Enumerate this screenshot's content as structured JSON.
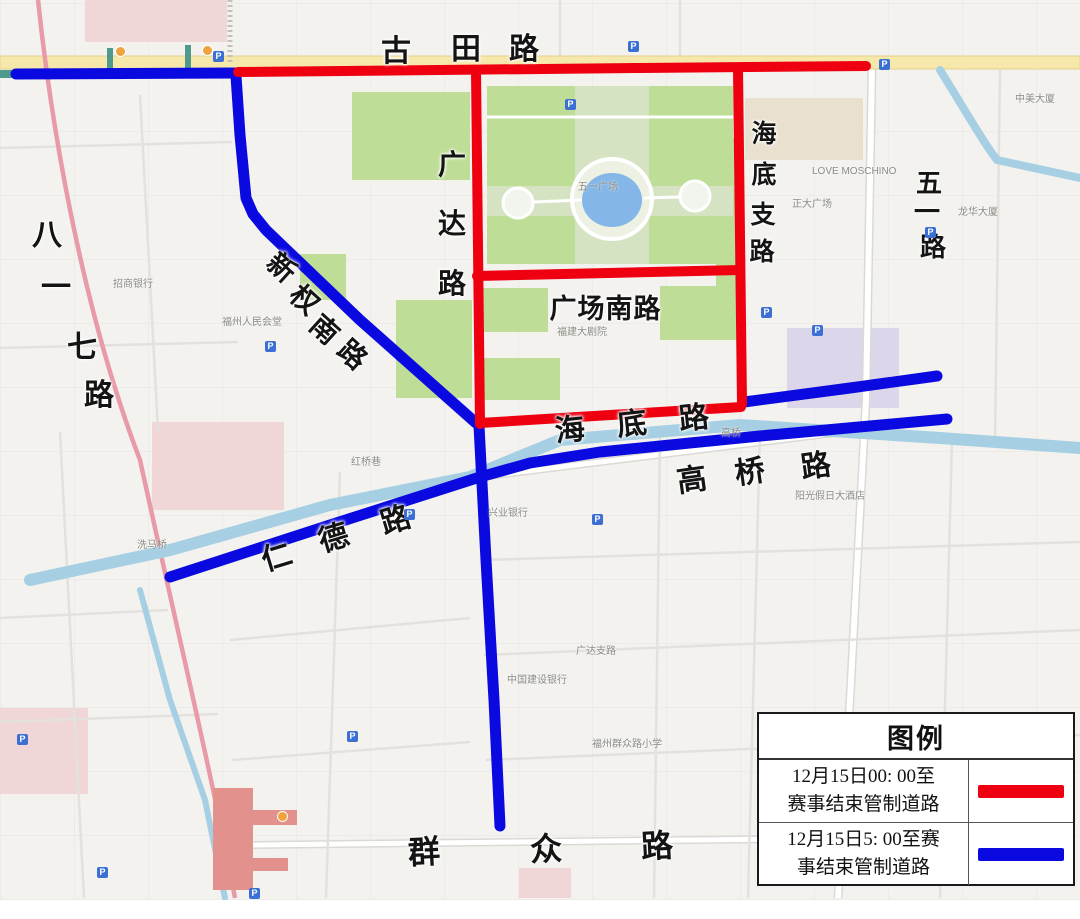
{
  "colors": {
    "restricted_red": "#ee0011",
    "restricted_blue": "#0a0ae0",
    "park_green": "#bedd96",
    "plaza_green": "#d6e3c3",
    "water_blue": "#a6cfe3",
    "pond_blue": "#84b7e8",
    "road_yellow": "#f6e8ab",
    "road_yellow_edge": "#e5cf8b",
    "pink_road": "#e89aa8",
    "pink_building": "#f0d6d6",
    "salmon_building": "#e2918d",
    "metro_green": "#4f9a8c",
    "station_orange": "#f0a23c",
    "lavender_building": "#dcd6ea",
    "tan_building": "#e9e0cf",
    "street_casing": "#dbd9d5",
    "street_fill": "#ffffff",
    "thin_street": "#e3e1dd"
  },
  "legend": {
    "title": "图例",
    "rows": [
      {
        "line1": "12月15日00: 00至",
        "line2": "赛事结束管制道路",
        "color": "#ee0011"
      },
      {
        "line1": "12月15日5: 00至赛",
        "line2": "事结束管制道路",
        "color": "#0a0ae0"
      }
    ]
  },
  "routes": {
    "red_width": 10,
    "blue_width": 11,
    "red": [
      {
        "name": "route-gutian-road-red",
        "points": [
          [
            238,
            72
          ],
          [
            640,
            68
          ],
          [
            866,
            66
          ]
        ]
      },
      {
        "name": "route-guangda-road-red",
        "points": [
          [
            476,
            71
          ],
          [
            480,
            424
          ]
        ]
      },
      {
        "name": "route-haidi-branch-red",
        "points": [
          [
            738,
            69
          ],
          [
            742,
            404
          ]
        ]
      },
      {
        "name": "route-square-south-red",
        "points": [
          [
            477,
            276
          ],
          [
            740,
            270
          ]
        ]
      },
      {
        "name": "route-haidi-west-red",
        "points": [
          [
            480,
            423
          ],
          [
            741,
            407
          ]
        ]
      }
    ],
    "blue": [
      {
        "name": "route-gutian-west-blue",
        "points": [
          [
            16,
            74
          ],
          [
            234,
            73
          ]
        ]
      },
      {
        "name": "route-xinquan-south-blue",
        "points": [
          [
            236,
            76
          ],
          [
            240,
            135
          ],
          [
            246,
            198
          ],
          [
            253,
            214
          ],
          [
            266,
            230
          ],
          [
            360,
            320
          ],
          [
            476,
            423
          ]
        ]
      },
      {
        "name": "route-center-south-blue",
        "points": [
          [
            479,
            426
          ],
          [
            486,
            560
          ],
          [
            494,
            700
          ],
          [
            500,
            826
          ]
        ]
      },
      {
        "name": "route-rende-gaoqiao-blue",
        "points": [
          [
            170,
            577
          ],
          [
            330,
            525
          ],
          [
            480,
            477
          ],
          [
            530,
            463
          ],
          [
            600,
            452
          ],
          [
            760,
            436
          ],
          [
            947,
            419
          ]
        ]
      },
      {
        "name": "route-haidi-east-blue",
        "points": [
          [
            744,
            402
          ],
          [
            850,
            388
          ],
          [
            937,
            376
          ]
        ]
      }
    ]
  },
  "road_labels": [
    {
      "name": "label-gutian-road",
      "size": 30,
      "rotate": 0,
      "chars": [
        {
          "t": "古",
          "x": 396,
          "y": 52
        },
        {
          "t": "田",
          "x": 466,
          "y": 50
        },
        {
          "t": "路",
          "x": 524,
          "y": 50
        }
      ]
    },
    {
      "name": "label-bayiqi-road",
      "size": 30,
      "rotate": 0,
      "chars": [
        {
          "t": "八",
          "x": 47,
          "y": 236
        },
        {
          "t": "一",
          "x": 56,
          "y": 288
        },
        {
          "t": "七",
          "x": 82,
          "y": 348
        },
        {
          "t": "路",
          "x": 99,
          "y": 396
        }
      ]
    },
    {
      "name": "label-xinquan-south-road",
      "size": 28,
      "rotate": 42,
      "chars": [
        {
          "t": "新",
          "x": 281,
          "y": 268
        },
        {
          "t": "权",
          "x": 304,
          "y": 300
        },
        {
          "t": "南",
          "x": 324,
          "y": 330
        },
        {
          "t": "路",
          "x": 352,
          "y": 355
        }
      ]
    },
    {
      "name": "label-guangda-road",
      "size": 28,
      "rotate": 0,
      "chars": [
        {
          "t": "广",
          "x": 452,
          "y": 165
        },
        {
          "t": "达",
          "x": 452,
          "y": 224
        },
        {
          "t": "路",
          "x": 452,
          "y": 284
        }
      ]
    },
    {
      "name": "label-haidi-branch-road",
      "size": 25,
      "rotate": 0,
      "chars": [
        {
          "t": "海",
          "x": 764,
          "y": 134
        },
        {
          "t": "底",
          "x": 764,
          "y": 175
        },
        {
          "t": "支",
          "x": 763,
          "y": 215
        },
        {
          "t": "路",
          "x": 762,
          "y": 252
        }
      ]
    },
    {
      "name": "label-wuyi-road",
      "size": 26,
      "rotate": 0,
      "chars": [
        {
          "t": "五",
          "x": 929,
          "y": 183
        },
        {
          "t": "一",
          "x": 927,
          "y": 212
        },
        {
          "t": "路",
          "x": 933,
          "y": 247
        }
      ]
    },
    {
      "name": "label-guangchang-south-road",
      "size": 27,
      "rotate": 0,
      "chars": [
        {
          "t": "广",
          "x": 563,
          "y": 309
        },
        {
          "t": "场",
          "x": 591,
          "y": 309
        },
        {
          "t": "南",
          "x": 619,
          "y": 309
        },
        {
          "t": "路",
          "x": 647,
          "y": 309
        }
      ]
    },
    {
      "name": "label-haidi-road",
      "size": 30,
      "rotate": -6,
      "chars": [
        {
          "t": "海",
          "x": 570,
          "y": 431
        },
        {
          "t": "底",
          "x": 632,
          "y": 425
        },
        {
          "t": "路",
          "x": 694,
          "y": 419
        }
      ]
    },
    {
      "name": "label-gaoqiao-road",
      "size": 30,
      "rotate": -8,
      "chars": [
        {
          "t": "高",
          "x": 692,
          "y": 481
        },
        {
          "t": "桥",
          "x": 750,
          "y": 473
        },
        {
          "t": "路",
          "x": 816,
          "y": 467
        }
      ]
    },
    {
      "name": "label-rende-road",
      "size": 30,
      "rotate": -17,
      "chars": [
        {
          "t": "仁",
          "x": 277,
          "y": 558
        },
        {
          "t": "德",
          "x": 334,
          "y": 539
        },
        {
          "t": "路",
          "x": 396,
          "y": 521
        }
      ]
    },
    {
      "name": "label-qunzhong-road",
      "size": 32,
      "rotate": -3,
      "chars": [
        {
          "t": "群",
          "x": 424,
          "y": 852
        },
        {
          "t": "众",
          "x": 546,
          "y": 849
        },
        {
          "t": "路",
          "x": 657,
          "y": 846
        }
      ]
    }
  ],
  "small_labels": [
    {
      "t": "五一广场",
      "x": 598,
      "y": 188
    },
    {
      "t": "福州人民会堂",
      "x": 252,
      "y": 323
    },
    {
      "t": "福建大剧院",
      "x": 582,
      "y": 333
    },
    {
      "t": "兴业银行",
      "x": 508,
      "y": 514
    },
    {
      "t": "招商银行",
      "x": 133,
      "y": 285
    },
    {
      "t": "阳光假日大酒店",
      "x": 830,
      "y": 497
    },
    {
      "t": "中国建设银行",
      "x": 537,
      "y": 681
    },
    {
      "t": "广达支路",
      "x": 596,
      "y": 652
    },
    {
      "t": "福州群众路小学",
      "x": 627,
      "y": 745
    },
    {
      "t": "正大广场",
      "x": 812,
      "y": 205
    },
    {
      "t": "LOVE MOSCHINO",
      "x": 877,
      "y": 172
    },
    {
      "t": "洗马桥",
      "x": 152,
      "y": 546
    },
    {
      "t": "红桥巷",
      "x": 366,
      "y": 463
    },
    {
      "t": "高桥",
      "x": 731,
      "y": 434
    },
    {
      "t": "中美大厦",
      "x": 1035,
      "y": 100
    },
    {
      "t": "龙华大厦",
      "x": 978,
      "y": 213
    }
  ],
  "parking_markers": [
    {
      "x": 218,
      "y": 56
    },
    {
      "x": 633,
      "y": 46
    },
    {
      "x": 884,
      "y": 64
    },
    {
      "x": 270,
      "y": 346
    },
    {
      "x": 409,
      "y": 514
    },
    {
      "x": 597,
      "y": 519
    },
    {
      "x": 930,
      "y": 232
    },
    {
      "x": 817,
      "y": 330
    },
    {
      "x": 352,
      "y": 736
    },
    {
      "x": 254,
      "y": 893
    },
    {
      "x": 102,
      "y": 872
    },
    {
      "x": 22,
      "y": 739
    },
    {
      "x": 766,
      "y": 312
    },
    {
      "x": 570,
      "y": 104
    }
  ],
  "metro_stations": [
    {
      "x": 120,
      "y": 51
    },
    {
      "x": 207,
      "y": 50
    },
    {
      "x": 282,
      "y": 816
    }
  ],
  "parking_letter": "P"
}
